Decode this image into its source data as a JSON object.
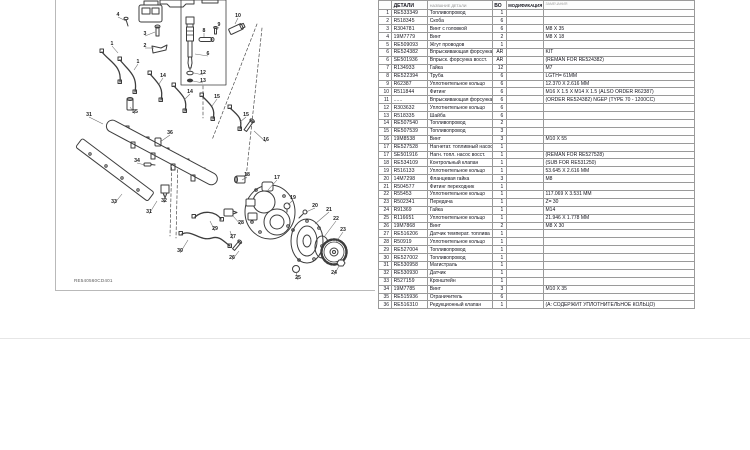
{
  "colors": {
    "page_background": "#ffffff",
    "line_art": "#3d3d3d",
    "table_outer_border": "#2e2e2e",
    "table_grid": "#9a9a9a",
    "text": "#13131c",
    "muted_header": "#8c8c8c"
  },
  "diagram": {
    "figure_id": "RE540560CD401",
    "callouts": [
      {
        "label": "4",
        "x": 62,
        "y": 16,
        "lx": 70,
        "ly": 21
      },
      {
        "label": "3",
        "x": 89,
        "y": 35,
        "lx": 99,
        "ly": 32
      },
      {
        "label": "2",
        "x": 89,
        "y": 47,
        "lx": 98,
        "ly": 48
      },
      {
        "label": "1",
        "x": 56,
        "y": 45,
        "lx": 62,
        "ly": 53
      },
      {
        "label": "1",
        "x": 82,
        "y": 63,
        "lx": 78,
        "ly": 70
      },
      {
        "label": "14",
        "x": 107,
        "y": 77,
        "lx": 103,
        "ly": 84
      },
      {
        "label": "14",
        "x": 134,
        "y": 93,
        "lx": 128,
        "ly": 100
      },
      {
        "label": "15",
        "x": 161,
        "y": 98,
        "lx": 156,
        "ly": 106
      },
      {
        "label": "15",
        "x": 190,
        "y": 116,
        "lx": 184,
        "ly": 122
      },
      {
        "label": "10",
        "x": 182,
        "y": 17,
        "lx": 179,
        "ly": 24
      },
      {
        "label": "9",
        "x": 163,
        "y": 26,
        "lx": 160,
        "ly": 31
      },
      {
        "label": "8",
        "x": 148,
        "y": 32,
        "lx": 148,
        "ly": 37
      },
      {
        "label": "6",
        "x": 152,
        "y": 55,
        "lx": 139,
        "ly": 54
      },
      {
        "label": "12",
        "x": 147,
        "y": 74,
        "lx": 138,
        "ly": 73
      },
      {
        "label": "13",
        "x": 147,
        "y": 82,
        "lx": 137,
        "ly": 81
      },
      {
        "label": "31",
        "x": 33,
        "y": 116,
        "lx": 47,
        "ly": 124
      },
      {
        "label": "35",
        "x": 79,
        "y": 113,
        "lx": 74,
        "ly": 107
      },
      {
        "label": "36",
        "x": 114,
        "y": 134,
        "lx": 104,
        "ly": 142
      },
      {
        "label": "34",
        "x": 81,
        "y": 162,
        "lx": 89,
        "ly": 165
      },
      {
        "label": "33",
        "x": 58,
        "y": 203,
        "lx": 66,
        "ly": 194
      },
      {
        "label": "32",
        "x": 108,
        "y": 202,
        "lx": 109,
        "ly": 194
      },
      {
        "label": "31",
        "x": 93,
        "y": 213,
        "lx": 101,
        "ly": 201
      },
      {
        "label": "16",
        "x": 210,
        "y": 141,
        "lx": 198,
        "ly": 131
      },
      {
        "label": "18",
        "x": 191,
        "y": 176,
        "lx": 186,
        "ly": 180
      },
      {
        "label": "17",
        "x": 221,
        "y": 179,
        "lx": 212,
        "ly": 190
      },
      {
        "label": "19",
        "x": 237,
        "y": 199,
        "lx": 232,
        "ly": 205
      },
      {
        "label": "20",
        "x": 259,
        "y": 207,
        "lx": 250,
        "ly": 212
      },
      {
        "label": "21",
        "x": 273,
        "y": 211,
        "lx": 259,
        "ly": 224
      },
      {
        "label": "22",
        "x": 280,
        "y": 220,
        "lx": 268,
        "ly": 237
      },
      {
        "label": "23",
        "x": 287,
        "y": 231,
        "lx": 280,
        "ly": 242
      },
      {
        "label": "24",
        "x": 278,
        "y": 274,
        "lx": 283,
        "ly": 266
      },
      {
        "label": "25",
        "x": 242,
        "y": 279,
        "lx": 240,
        "ly": 272
      },
      {
        "label": "26",
        "x": 176,
        "y": 259,
        "lx": 183,
        "ly": 251
      },
      {
        "label": "27",
        "x": 177,
        "y": 238,
        "lx": 174,
        "ly": 231
      },
      {
        "label": "28",
        "x": 185,
        "y": 224,
        "lx": 177,
        "ly": 216
      },
      {
        "label": "29",
        "x": 159,
        "y": 230,
        "lx": 154,
        "ly": 221
      },
      {
        "label": "30",
        "x": 124,
        "y": 252,
        "lx": 132,
        "ly": 240
      }
    ]
  },
  "table": {
    "headers": {
      "num": "",
      "part": "ДЕТАЛИ",
      "name": "НАЗВАНИЕ ДЕТАЛИ",
      "qty": "ВО",
      "mod": "МОДИФИКАЦИЯ",
      "remarks": "ЗАМЕЧАНИЯ"
    },
    "rows": [
      [
        "1",
        "RE533349",
        "Топливопровод",
        "1",
        "",
        ""
      ],
      [
        "2",
        "R518345",
        "Скоба",
        "6",
        "",
        ""
      ],
      [
        "3",
        "R304781",
        "Винт с головкой",
        "6",
        "",
        "M8 X 35"
      ],
      [
        "4",
        "19M7779",
        "Винт",
        "2",
        "",
        "M8 X 18"
      ],
      [
        "5",
        "RE509093",
        "Жгут проводов",
        "1",
        "",
        ""
      ],
      [
        "6",
        "RE524382",
        "Впрыскивающая форсунка",
        "AR",
        "",
        "KIT"
      ],
      [
        "6",
        "SE501936",
        "Впрыск. форсунка восст.",
        "AR",
        "",
        "(REMAN FOR RE524382)"
      ],
      [
        "7",
        "R134933",
        "Гайка",
        "12",
        "",
        "M7"
      ],
      [
        "8",
        "RE522394",
        "Труба",
        "6",
        "",
        "LGTH= 61MM"
      ],
      [
        "9",
        "R62387",
        "Уплотнительное кольцо",
        "6",
        "",
        "12.370 X 2.616 MM"
      ],
      [
        "10",
        "R511844",
        "Фитинг",
        "6",
        "",
        "M16 X 1.5 X M14 X 1.5 (ALSO ORDER R62387)"
      ],
      [
        "11",
        "......",
        "Впрыскивающая форсунка",
        "6",
        "",
        "(ORDER RE524382) NGEP (TYPE 70 - 1200CC)"
      ],
      [
        "12",
        "R303632",
        "Уплотнительное кольцо",
        "6",
        "",
        ""
      ],
      [
        "13",
        "R518335",
        "Шайба",
        "6",
        "",
        ""
      ],
      [
        "14",
        "RE507540",
        "Топливопровод",
        "2",
        "",
        ""
      ],
      [
        "15",
        "RE507539",
        "Топливопровод",
        "3",
        "",
        ""
      ],
      [
        "16",
        "19M8538",
        "Винт",
        "3",
        "",
        "M10 X 55"
      ],
      [
        "17",
        "RE527528",
        "Нагнетат. топливный насос",
        "1",
        "",
        ""
      ],
      [
        "17",
        "SE501916",
        "Нагн. топл. насос восст.",
        "1",
        "",
        "(REMAN FOR RE527528)"
      ],
      [
        "18",
        "RE534109",
        "Контрольный клапан",
        "1",
        "",
        "(SUB FOR RE531250)"
      ],
      [
        "19",
        "R516133",
        "Уплотнительное кольцо",
        "1",
        "",
        "53.645 X 2.616 MM"
      ],
      [
        "20",
        "14M7298",
        "Фланцевая гайка",
        "3",
        "",
        "M8"
      ],
      [
        "21",
        "R504577",
        "Фитинг переходник",
        "1",
        "",
        ""
      ],
      [
        "22",
        "R55453",
        "Уплотнительное кольцо",
        "1",
        "",
        "117.069 X 3.531 MM"
      ],
      [
        "23",
        "R502341",
        "Передача",
        "1",
        "",
        "Z= 30"
      ],
      [
        "24",
        "R91369",
        "Гайка",
        "1",
        "",
        "M14"
      ],
      [
        "25",
        "R116651",
        "Уплотнительное кольцо",
        "1",
        "",
        "21.946 X 1.778 MM"
      ],
      [
        "26",
        "19M7868",
        "Винт",
        "2",
        "",
        "M8 X 30"
      ],
      [
        "27",
        "RE516206",
        "Датчик температ. топлива",
        "1",
        "",
        ""
      ],
      [
        "28",
        "R50919",
        "Уплотнительное кольцо",
        "1",
        "",
        ""
      ],
      [
        "29",
        "RE527004",
        "Топливопровод",
        "1",
        "",
        ""
      ],
      [
        "30",
        "RE527002",
        "Топливопровод",
        "1",
        "",
        ""
      ],
      [
        "31",
        "RE530958",
        "Магистраль",
        "1",
        "",
        ""
      ],
      [
        "32",
        "RE530930",
        "Датчик",
        "1",
        "",
        ""
      ],
      [
        "33",
        "R527159",
        "Кронштейн",
        "1",
        "",
        ""
      ],
      [
        "34",
        "19M7785",
        "Винт",
        "3",
        "",
        "M10 X 35"
      ],
      [
        "35",
        "RE515936",
        "Ограничитель",
        "6",
        "",
        ""
      ],
      [
        "36",
        "RE516310",
        "Редукционный клапан",
        "1",
        "",
        "(A: СОДЕРЖИТ УПЛОТНИТЕЛЬНОЕ КОЛЬЦО)"
      ]
    ]
  }
}
